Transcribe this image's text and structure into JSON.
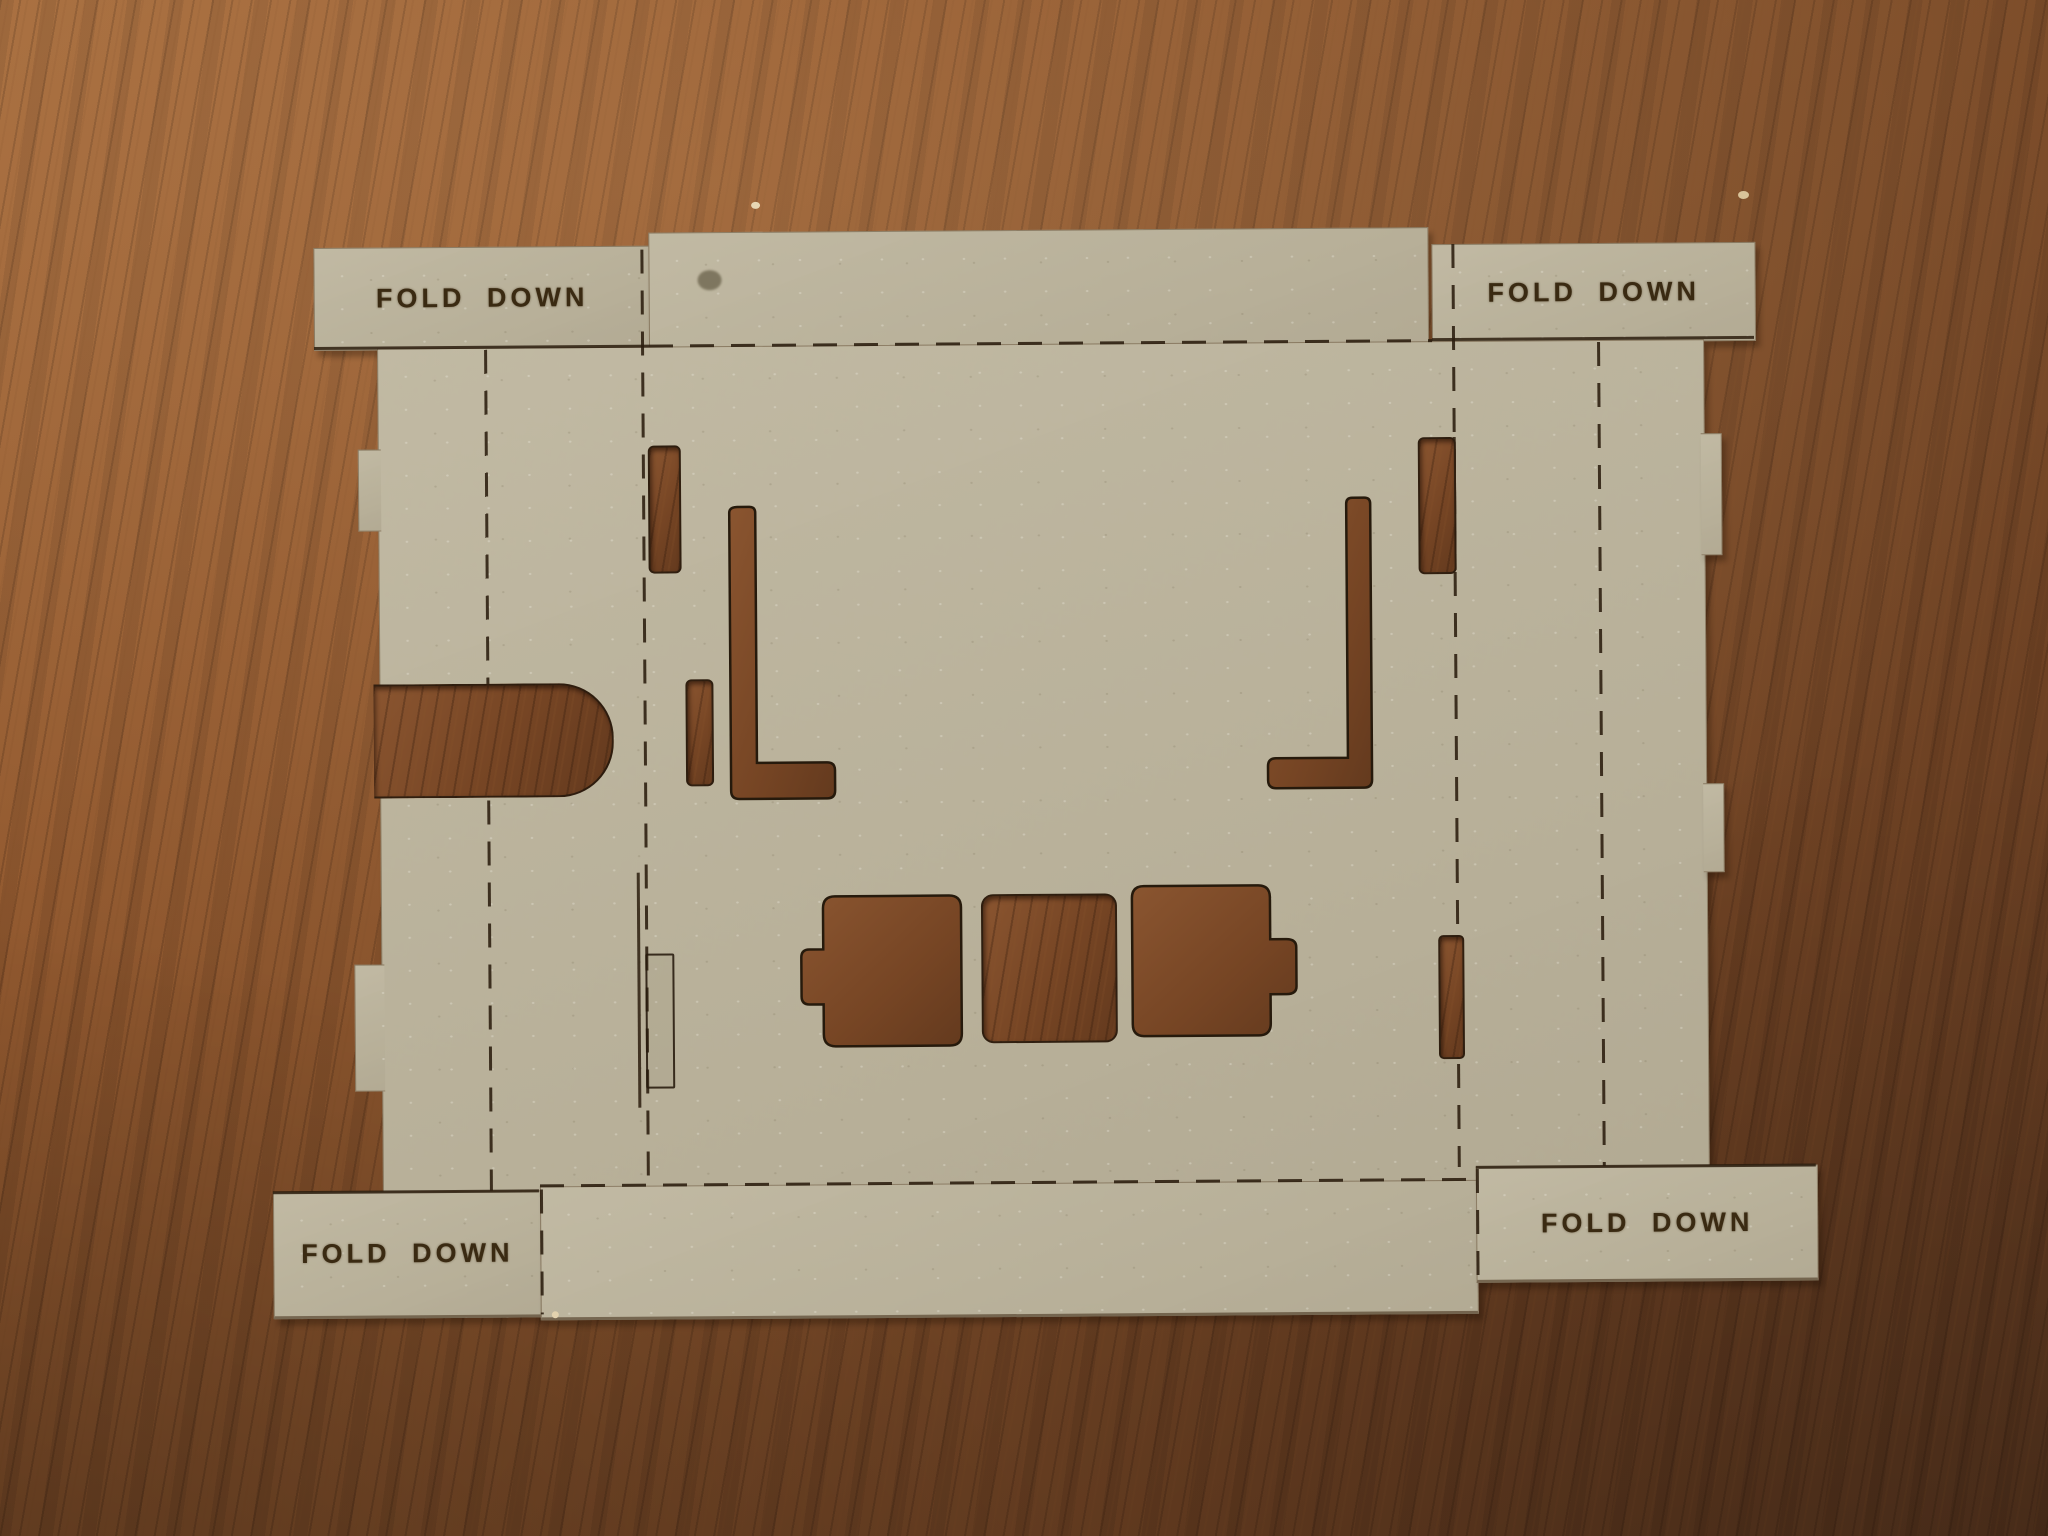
{
  "scene": {
    "description": "Photograph of a laser-cut cardboard fold-up box template lying flat on a wooden table",
    "object": "laser-cut cardboard template",
    "surface": "dark walnut wood table",
    "colors": {
      "wood_light": "#a2683a",
      "wood_mid": "#7e4d29",
      "wood_dark": "#5c3820",
      "cardboard": "#bcb49d",
      "cut_line": "#2b1d0e",
      "engraved_text": "#3a2a12"
    }
  },
  "template": {
    "flaps": [
      {
        "position": "top-left",
        "label": "FOLD DOWN"
      },
      {
        "position": "top-right",
        "label": "FOLD DOWN"
      },
      {
        "position": "bottom-left",
        "label": "FOLD DOWN"
      },
      {
        "position": "bottom-right",
        "label": "FOLD DOWN"
      }
    ],
    "fold_line_style": "dashed engraved fold lines",
    "cutouts": [
      "narrow slot upper-left",
      "narrow slot mid-left",
      "L-bracket cutout left",
      "mirrored L-bracket cutout right",
      "narrow slot upper-right",
      "tab slot lower-right",
      "scored tab slot outline lower-left (piece not removed)",
      "battery-shaped cutout with left terminal tab",
      "square cutout middle",
      "battery-shaped cutout with right terminal tab",
      "rounded thumb notch on left edge"
    ]
  }
}
